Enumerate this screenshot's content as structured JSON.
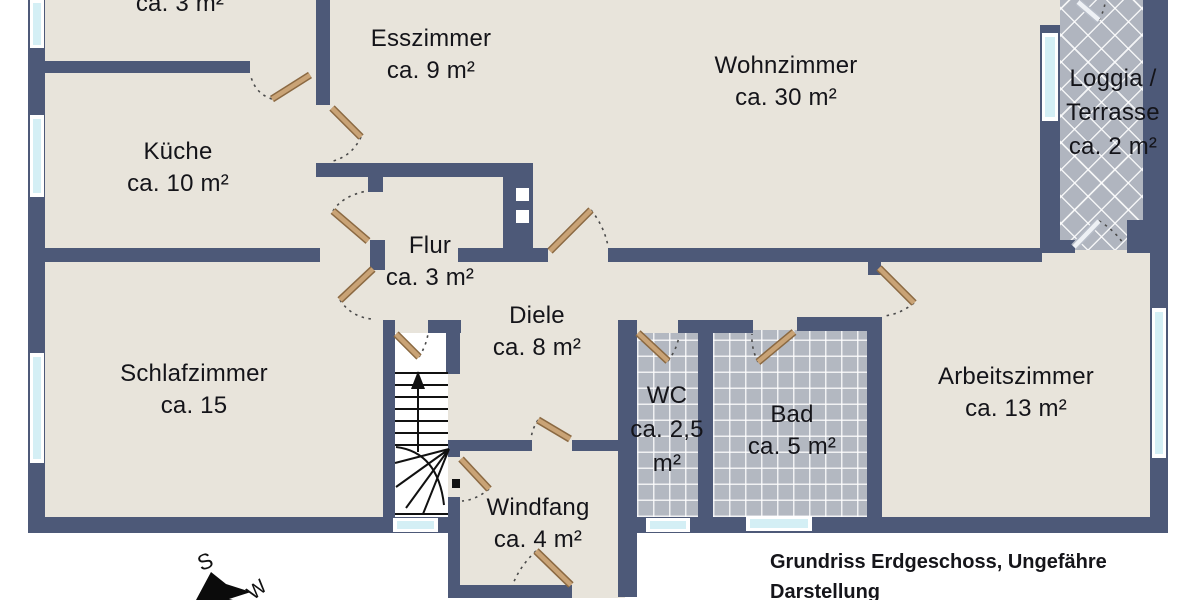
{
  "plan": {
    "caption_line1": "Grundriss Erdgeschoss, Ungefähre",
    "caption_line2": "Darstellung"
  },
  "rooms": [
    {
      "id": "storage-top-left",
      "name": "",
      "area": "ca. 3 m²",
      "lines": [
        "ca. 3 m²"
      ]
    },
    {
      "id": "esszimmer",
      "name": "Esszimmer",
      "area": "ca. 9 m²",
      "lines": [
        "Esszimmer",
        "ca. 9 m²"
      ]
    },
    {
      "id": "kueche",
      "name": "Küche",
      "area": "ca. 10 m²",
      "lines": [
        "Küche",
        "ca. 10 m²"
      ]
    },
    {
      "id": "wohnzimmer",
      "name": "Wohnzimmer",
      "area": "ca. 30 m²",
      "lines": [
        "Wohnzimmer",
        "ca. 30 m²"
      ]
    },
    {
      "id": "loggia-terrasse",
      "name": "Loggia / Terrasse",
      "area": "ca. 2 m²",
      "lines": [
        "Loggia /",
        "Terrasse",
        "ca. 2 m²"
      ]
    },
    {
      "id": "flur",
      "name": "Flur",
      "area": "ca. 3 m²",
      "lines": [
        "Flur",
        "ca. 3 m²"
      ]
    },
    {
      "id": "diele",
      "name": "Diele",
      "area": "ca. 8 m²",
      "lines": [
        "Diele",
        "ca. 8 m²"
      ]
    },
    {
      "id": "schlafzimmer",
      "name": "Schlafzimmer",
      "area": "ca. 15",
      "lines": [
        "Schlafzimmer",
        "ca. 15"
      ]
    },
    {
      "id": "wc",
      "name": "WC",
      "area": "ca. 2,5 m²",
      "lines": [
        "WC",
        "ca. 2,5",
        "m²"
      ]
    },
    {
      "id": "bad",
      "name": "Bad",
      "area": "ca. 5 m²",
      "lines": [
        "Bad",
        "ca. 5 m²"
      ]
    },
    {
      "id": "arbeitszimmer",
      "name": "Arbeitszimmer",
      "area": "ca. 13 m²",
      "lines": [
        "Arbeitszimmer",
        "ca. 13 m²"
      ]
    },
    {
      "id": "windfang",
      "name": "Windfang",
      "area": "ca. 4 m²",
      "lines": [
        "Windfang",
        "ca. 4 m²"
      ]
    }
  ],
  "compass": {
    "south": "S",
    "west": "W"
  },
  "colors": {
    "wall": "#4d5978",
    "floor": "#e8e4db",
    "tile": "#b3b8c1",
    "window_glass": "#d4eff5",
    "door_blade": "#c9a376",
    "outside": "#ffffff"
  }
}
